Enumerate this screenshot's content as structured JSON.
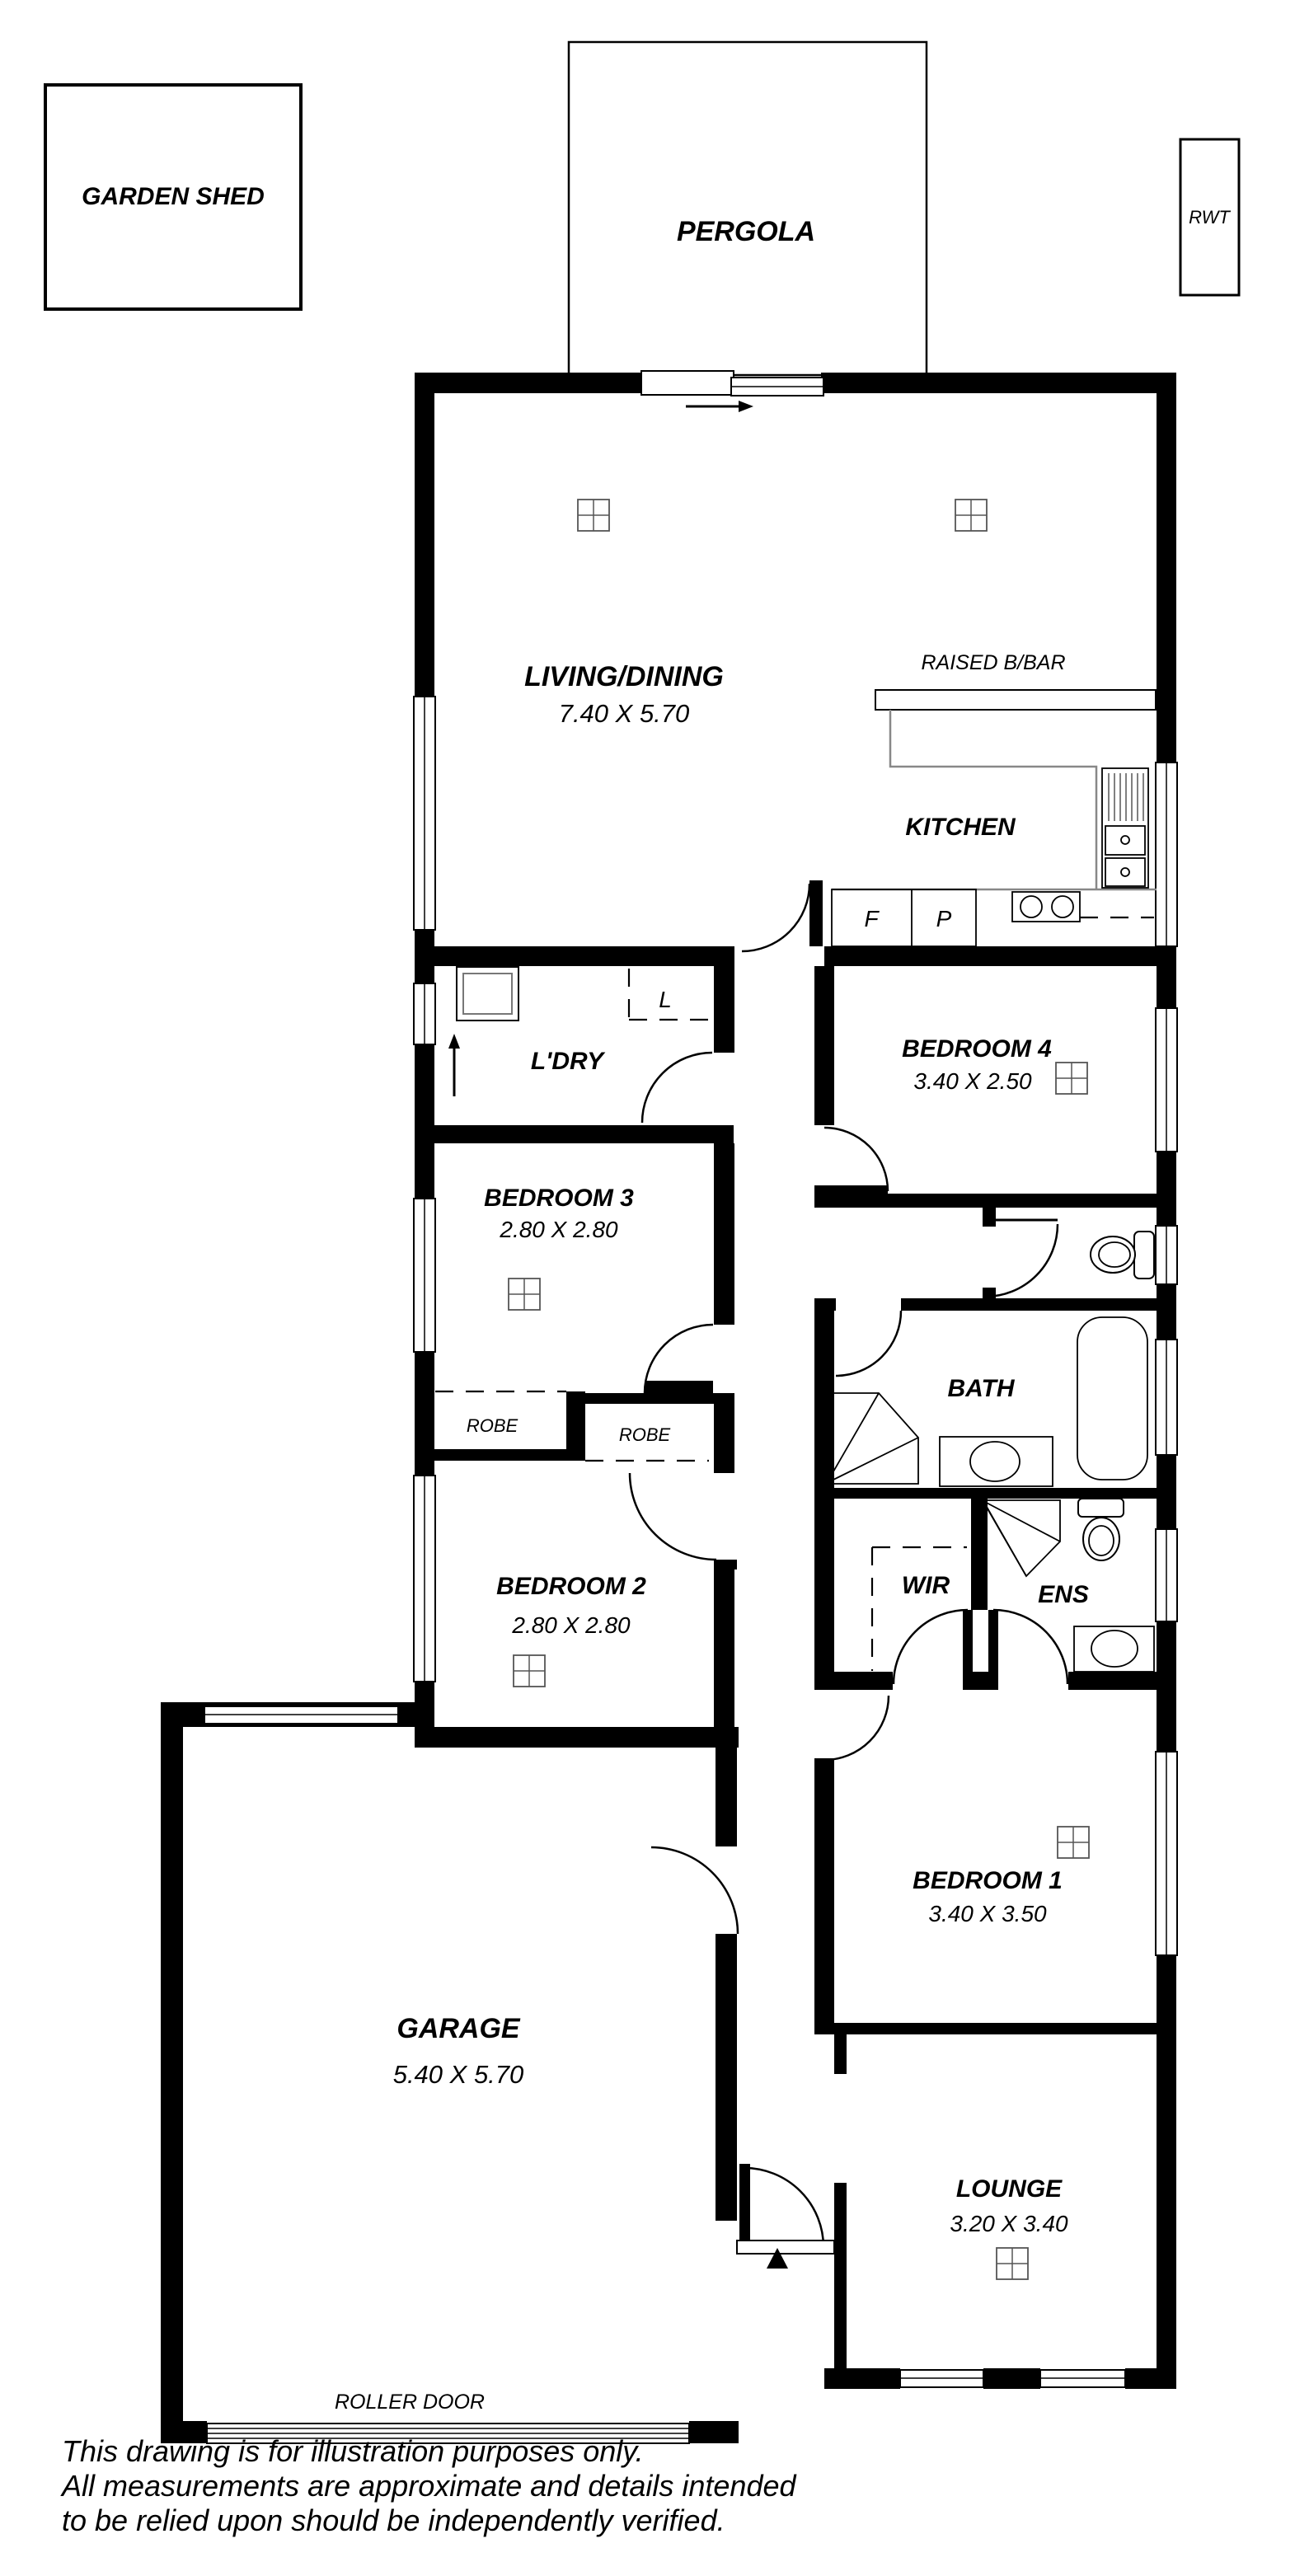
{
  "plan": {
    "outbuildings": {
      "garden_shed": "GARDEN SHED",
      "pergola": "PERGOLA",
      "rwt": "RWT"
    },
    "rooms": {
      "living": {
        "name": "LIVING/DINING",
        "dims": "7.40 X 5.70"
      },
      "kitchen": {
        "name": "KITCHEN"
      },
      "raised_bbar": "RAISED B/BAR",
      "laundry": {
        "name": "L'DRY"
      },
      "bed4": {
        "name": "BEDROOM 4",
        "dims": "3.40 X 2.50"
      },
      "bed3": {
        "name": "BEDROOM 3",
        "dims": "2.80 X 2.80"
      },
      "bed2": {
        "name": "BEDROOM 2",
        "dims": "2.80 X 2.80"
      },
      "bed1": {
        "name": "BEDROOM 1",
        "dims": "3.40 X 3.50"
      },
      "bath": {
        "name": "BATH"
      },
      "wir": {
        "name": "WIR"
      },
      "ens": {
        "name": "ENS"
      },
      "garage": {
        "name": "GARAGE",
        "dims": "5.40 X 5.70"
      },
      "lounge": {
        "name": "LOUNGE",
        "dims": "3.20 X 3.40"
      },
      "robe_left": "ROBE",
      "robe_right": "ROBE",
      "fridge": "F",
      "pantry": "P",
      "linen": "L",
      "roller_door": "ROLLER DOOR"
    },
    "disclaimer": [
      "This drawing is for illustration purposes only.",
      "All measurements are approximate and details intended",
      "to be relied upon should be independently verified."
    ],
    "colors": {
      "ink": "#000000",
      "bench": "#888888",
      "paper": "#ffffff"
    }
  }
}
